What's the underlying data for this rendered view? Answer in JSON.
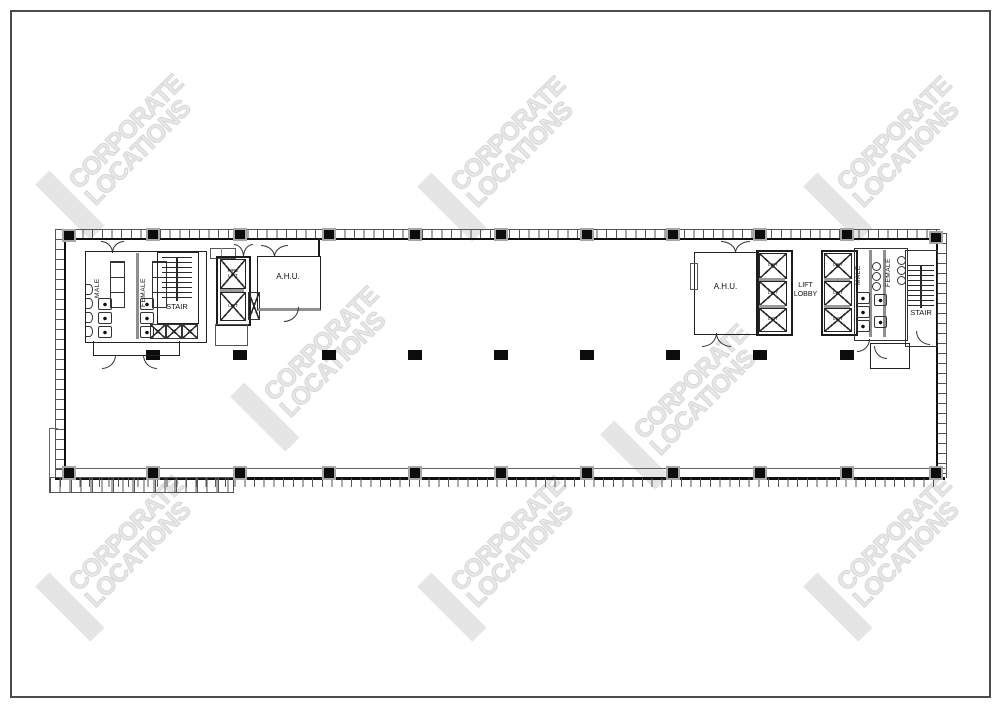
{
  "page": {
    "background": "#ffffff",
    "border_color": "#4b4b4b"
  },
  "watermark": {
    "line1": "CORPORATE",
    "line2": "LOCATIONS",
    "color": "#e7e7e7"
  },
  "plan": {
    "left_core": {
      "male": "MALE",
      "female": "FEMALE",
      "stair": "STAIR",
      "fire_lift_line1": "FIRE",
      "fire_lift_line2": "LIFT",
      "lift": "LIFT",
      "ahu": "A.H.U."
    },
    "right_core": {
      "ahu": "A.H.U.",
      "lift": "LIFT",
      "lobby_line1": "LIFT",
      "lobby_line2": "LOBBY",
      "male": "MALE",
      "female": "FEMALE",
      "stair": "STAIR"
    }
  }
}
